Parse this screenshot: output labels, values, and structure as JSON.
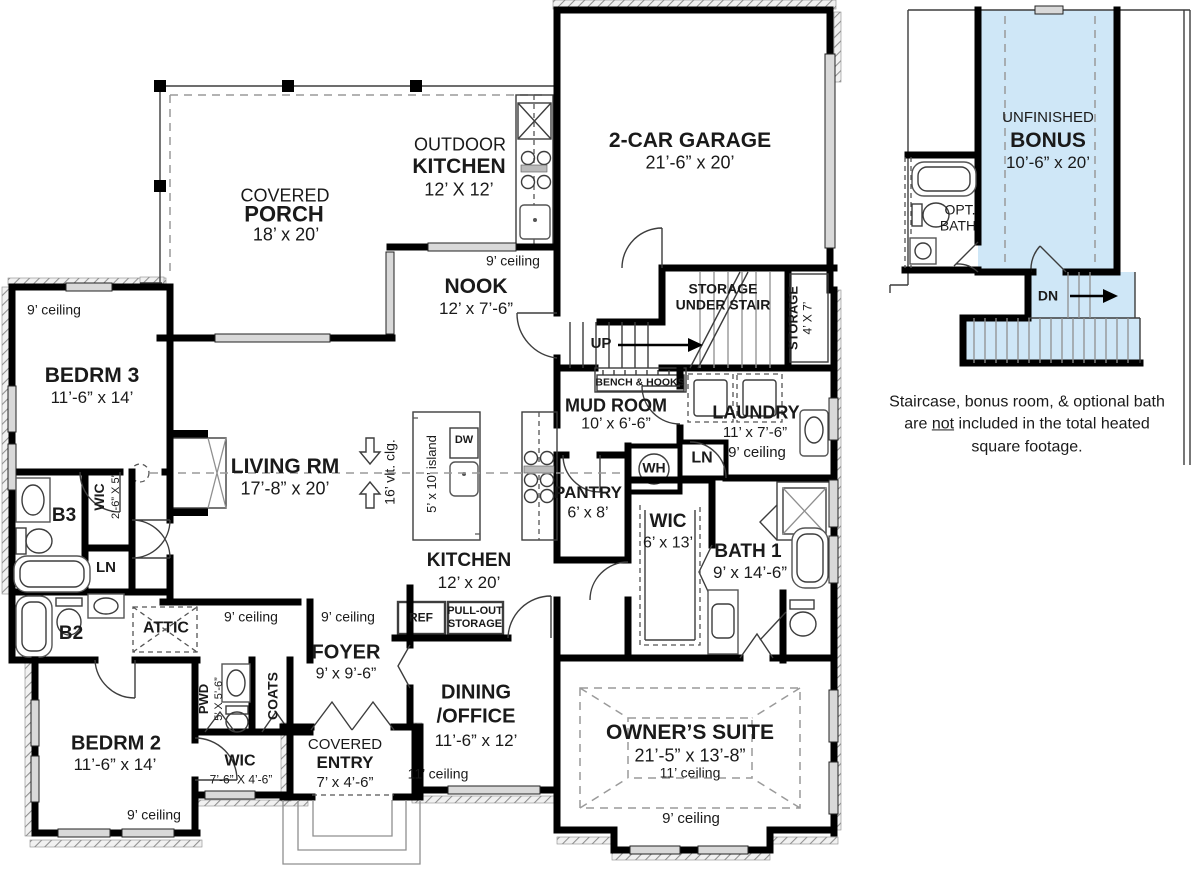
{
  "colors": {
    "bonus_fill": "#cfe7f7",
    "wall": "#000000",
    "window": "#d9d9d9"
  },
  "main_floor": {
    "covered_porch": {
      "line1": "COVERED",
      "line2": "PORCH",
      "dims": "18’ x 20’"
    },
    "outdoor_kitchen": {
      "line1": "OUTDOOR",
      "line2": "KITCHEN",
      "dims": "12’ X 12’"
    },
    "garage": {
      "name": "2-CAR GARAGE",
      "dims": "21’-6” x 20’"
    },
    "nook": {
      "ceiling": "9’ ceiling",
      "name": "NOOK",
      "dims": "12’ x 7’-6”"
    },
    "storage_under_stair": {
      "line1": "STORAGE",
      "line2": "UNDER STAIR"
    },
    "storage_4x7": {
      "name": "STORAGE",
      "dims": "4’ X 7’"
    },
    "stairs_up": "UP",
    "bench_hooks": "BENCH & HOOKS",
    "bedrm3": {
      "ceiling": "9’ ceiling",
      "name": "BEDRM 3",
      "dims": "11’-6” x 14’"
    },
    "b3": "B3",
    "wic_b3": {
      "name": "WIC",
      "dims": "2’-6” X 5’"
    },
    "ln_b3": "LN",
    "living": {
      "name": "LIVING RM",
      "dims": "17’-8” x 20’",
      "vault": "16’ vlt. clg."
    },
    "island": "5’ x 10’ island",
    "dw": "DW",
    "kitchen": {
      "name": "KITCHEN",
      "dims": "12’ x 20’"
    },
    "ref": "REF",
    "pullout": {
      "line1": "PULL-OUT",
      "line2": "STORAGE"
    },
    "mud_room": {
      "name": "MUD ROOM",
      "dims": "10’ x 6’-6”"
    },
    "wh": "WH",
    "ln_mud": "LN",
    "laundry": {
      "name": "LAUNDRY",
      "dims": "11’ x 7’-6”",
      "ceiling": "9’ ceiling"
    },
    "pantry": {
      "name": "PANTRY",
      "dims": "6’ x 8’"
    },
    "wic_owner": {
      "name": "WIC",
      "dims": "6’ x 13’"
    },
    "bath1": {
      "name": "BATH 1",
      "dims": "9’ x 14’-6”"
    },
    "attic": "ATTIC",
    "ceiling_9_hall": "9’ ceiling",
    "ceiling_9_foyer": "9’ ceiling",
    "foyer": {
      "name": "FOYER",
      "dims": "9’ x 9’-6”"
    },
    "pwd": {
      "name": "PWD",
      "dims": "5’ X 5’-6”"
    },
    "coats": "COATS",
    "dining": {
      "line1": "DINING",
      "line2": "/OFFICE",
      "dims": "11’-6” x 12’",
      "ceiling": "11’ ceiling"
    },
    "owners_suite": {
      "name": "OWNER’S SUITE",
      "dims": "21’-5” x 13’-8”",
      "ceiling": "11’ ceiling",
      "ceiling2": "9’ ceiling"
    },
    "bedrm2": {
      "name": "BEDRM 2",
      "dims": "11’-6” x 14’",
      "ceiling": "9’ ceiling"
    },
    "b2": "B2",
    "wic_bedrm2": {
      "name": "WIC",
      "dims": "7’-6” X 4’-6”"
    },
    "covered_entry": {
      "line1": "COVERED",
      "line2": "ENTRY",
      "dims": "7’ x 4’-6”"
    }
  },
  "bonus_floor": {
    "bonus": {
      "line1": "UNFINISHED",
      "line2": "BONUS",
      "dims": "10’-6” x 20’"
    },
    "opt_bath": {
      "line1": "OPT.",
      "line2": "BATH"
    },
    "dn": "DN",
    "note": {
      "line1": "Staircase, bonus room, & optional bath",
      "line2_pre": "are ",
      "line2_u": "not",
      "line2_post": " included in the total heated",
      "line3": "square footage."
    }
  }
}
